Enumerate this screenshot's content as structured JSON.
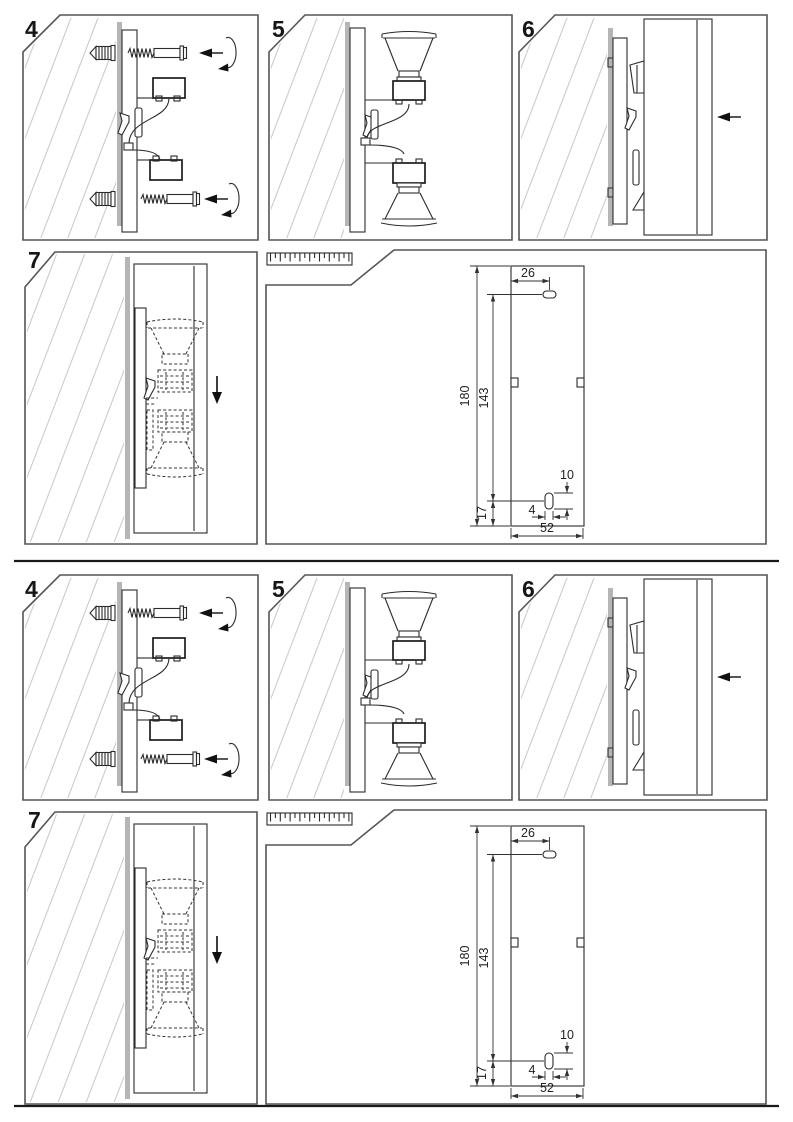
{
  "sheet": {
    "background": "#ffffff",
    "separator_color": "#1a1a1a",
    "drawing_line_color": "#2b2b2b",
    "panel_border_color": "#555555",
    "hatch_color": "#cccccc",
    "wall_shadow_color": "#b5b5b5"
  },
  "steps": {
    "step4": "4",
    "step5": "5",
    "step6": "6",
    "step7": "7"
  },
  "dimensions": {
    "top_hole_offset": "26",
    "plate_total_height": "180",
    "hole_spacing": "143",
    "slot_height": "10",
    "bottom_hole_offset": "17",
    "slot_width": "4",
    "plate_total_width": "52"
  }
}
